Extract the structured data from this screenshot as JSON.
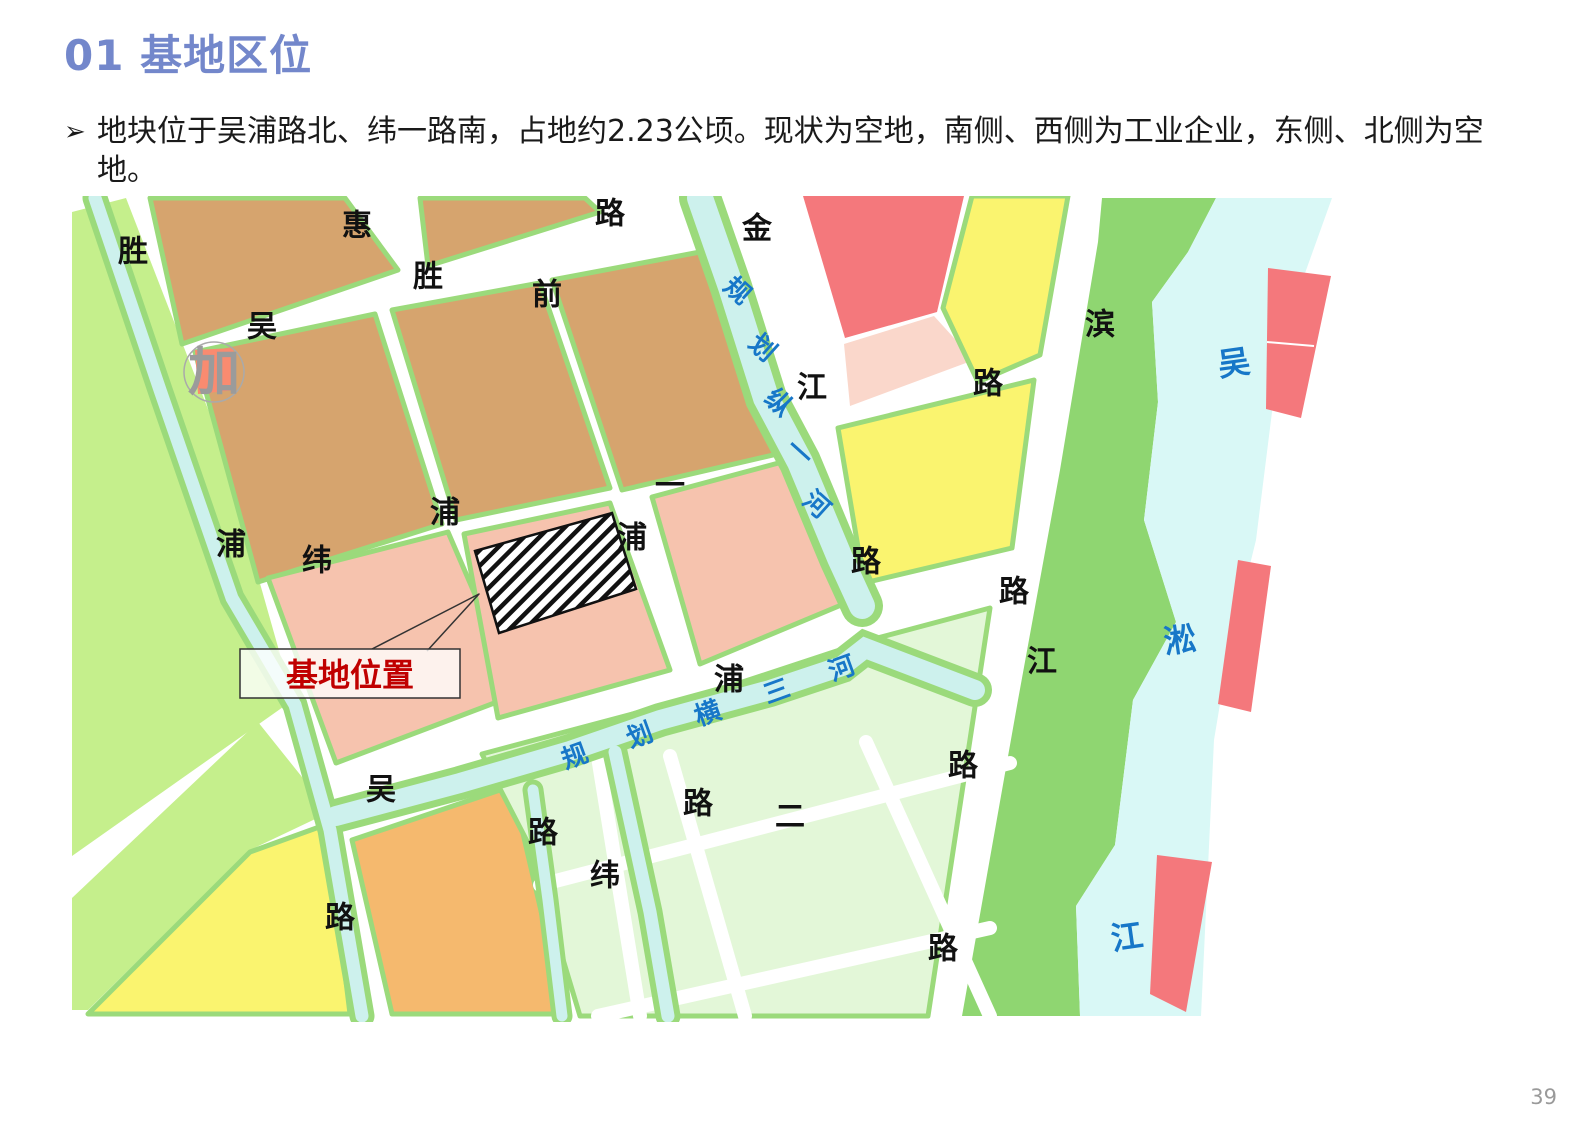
{
  "page": {
    "title": "01 基地区位",
    "bullet": "地块位于吴浦路北、纬一路南，占地约2.23公顷。现状为空地，南侧、西侧为工业企业，东侧、北侧为空地。",
    "page_number": "39"
  },
  "map": {
    "callout": "基地位置",
    "palette": {
      "tan": "#D6A46E",
      "pink": "#F6C3AE",
      "palepink": "#FAD7CB",
      "red": "#F4787C",
      "salmon": "#F98B70",
      "yellow": "#FAF46F",
      "lgreen": "#C5EF8C",
      "mint": "#E3F7D8",
      "green": "#8FD671",
      "edge": "#9BDA7B",
      "orange": "#F5B96E",
      "river": "#D9F8F6",
      "canal": "#CDF1ED",
      "roadLabel": "#111111",
      "waterLabel": "#1777C8",
      "stationLabel": "#9B9B9B",
      "calloutRed": "#C00000",
      "title": "#7387CB",
      "pageNum": "#9A9A9A"
    },
    "labels": [
      {
        "t": "胜",
        "x": 133,
        "y": 252,
        "c": "roadLabel",
        "s": 30,
        "r": 0
      },
      {
        "t": "惠",
        "x": 357,
        "y": 226,
        "c": "roadLabel",
        "s": 30,
        "r": 0
      },
      {
        "t": "路",
        "x": 610,
        "y": 214,
        "c": "roadLabel",
        "s": 30,
        "r": 0
      },
      {
        "t": "金",
        "x": 757,
        "y": 229,
        "c": "roadLabel",
        "s": 30,
        "r": 0
      },
      {
        "t": "胜",
        "x": 428,
        "y": 277,
        "c": "roadLabel",
        "s": 30,
        "r": 0
      },
      {
        "t": "前",
        "x": 547,
        "y": 295,
        "c": "roadLabel",
        "s": 30,
        "r": 0
      },
      {
        "t": "吴",
        "x": 262,
        "y": 327,
        "c": "roadLabel",
        "s": 30,
        "r": 0
      },
      {
        "t": "江",
        "x": 812,
        "y": 388,
        "c": "roadLabel",
        "s": 30,
        "r": 0
      },
      {
        "t": "滨",
        "x": 1100,
        "y": 325,
        "c": "roadLabel",
        "s": 30,
        "r": 0
      },
      {
        "t": "路",
        "x": 988,
        "y": 384,
        "c": "roadLabel",
        "s": 30,
        "r": 0
      },
      {
        "t": "浦",
        "x": 445,
        "y": 513,
        "c": "roadLabel",
        "s": 30,
        "r": 0
      },
      {
        "t": "浦",
        "x": 231,
        "y": 545,
        "c": "roadLabel",
        "s": 30,
        "r": 0
      },
      {
        "t": "纬",
        "x": 317,
        "y": 561,
        "c": "roadLabel",
        "s": 30,
        "r": 0
      },
      {
        "t": "一",
        "x": 670,
        "y": 486,
        "c": "roadLabel",
        "s": 30,
        "r": 0
      },
      {
        "t": "浦",
        "x": 632,
        "y": 538,
        "c": "roadLabel",
        "s": 30,
        "r": 0
      },
      {
        "t": "路",
        "x": 866,
        "y": 562,
        "c": "roadLabel",
        "s": 30,
        "r": 0
      },
      {
        "t": "浦",
        "x": 729,
        "y": 680,
        "c": "roadLabel",
        "s": 30,
        "r": 0
      },
      {
        "t": "路",
        "x": 1014,
        "y": 592,
        "c": "roadLabel",
        "s": 30,
        "r": 0
      },
      {
        "t": "江",
        "x": 1042,
        "y": 662,
        "c": "roadLabel",
        "s": 30,
        "r": 0
      },
      {
        "t": "吴",
        "x": 381,
        "y": 790,
        "c": "roadLabel",
        "s": 30,
        "r": 0
      },
      {
        "t": "路",
        "x": 543,
        "y": 833,
        "c": "roadLabel",
        "s": 30,
        "r": 0
      },
      {
        "t": "路",
        "x": 340,
        "y": 918,
        "c": "roadLabel",
        "s": 30,
        "r": 0
      },
      {
        "t": "纬",
        "x": 605,
        "y": 876,
        "c": "roadLabel",
        "s": 30,
        "r": 0
      },
      {
        "t": "路",
        "x": 698,
        "y": 804,
        "c": "roadLabel",
        "s": 30,
        "r": 0
      },
      {
        "t": "二",
        "x": 790,
        "y": 817,
        "c": "roadLabel",
        "s": 30,
        "r": 0
      },
      {
        "t": "路",
        "x": 963,
        "y": 766,
        "c": "roadLabel",
        "s": 30,
        "r": 0
      },
      {
        "t": "路",
        "x": 943,
        "y": 949,
        "c": "roadLabel",
        "s": 30,
        "r": 0
      },
      {
        "t": "规",
        "x": 737,
        "y": 291,
        "c": "waterLabel",
        "s": 26,
        "r": 42
      },
      {
        "t": "划",
        "x": 762,
        "y": 348,
        "c": "waterLabel",
        "s": 26,
        "r": 42
      },
      {
        "t": "纵",
        "x": 778,
        "y": 403,
        "c": "waterLabel",
        "s": 26,
        "r": 42
      },
      {
        "t": "一",
        "x": 799,
        "y": 453,
        "c": "waterLabel",
        "s": 26,
        "r": 42
      },
      {
        "t": "河",
        "x": 816,
        "y": 505,
        "c": "waterLabel",
        "s": 26,
        "r": 42
      },
      {
        "t": "规",
        "x": 575,
        "y": 757,
        "c": "waterLabel",
        "s": 26,
        "r": -20
      },
      {
        "t": "划",
        "x": 640,
        "y": 736,
        "c": "waterLabel",
        "s": 26,
        "r": -20
      },
      {
        "t": "横",
        "x": 708,
        "y": 714,
        "c": "waterLabel",
        "s": 26,
        "r": -20
      },
      {
        "t": "三",
        "x": 777,
        "y": 692,
        "c": "waterLabel",
        "s": 26,
        "r": -20
      },
      {
        "t": "河",
        "x": 842,
        "y": 669,
        "c": "waterLabel",
        "s": 26,
        "r": -20
      },
      {
        "t": "吴",
        "x": 1234,
        "y": 363,
        "c": "waterLabel",
        "s": 32,
        "r": -8
      },
      {
        "t": "淞",
        "x": 1180,
        "y": 640,
        "c": "waterLabel",
        "s": 32,
        "r": -8
      },
      {
        "t": "江",
        "x": 1127,
        "y": 937,
        "c": "waterLabel",
        "s": 32,
        "r": -8
      },
      {
        "t": "加",
        "x": 214,
        "y": 373,
        "c": "stationLabel",
        "s": 52,
        "r": 0
      }
    ]
  }
}
